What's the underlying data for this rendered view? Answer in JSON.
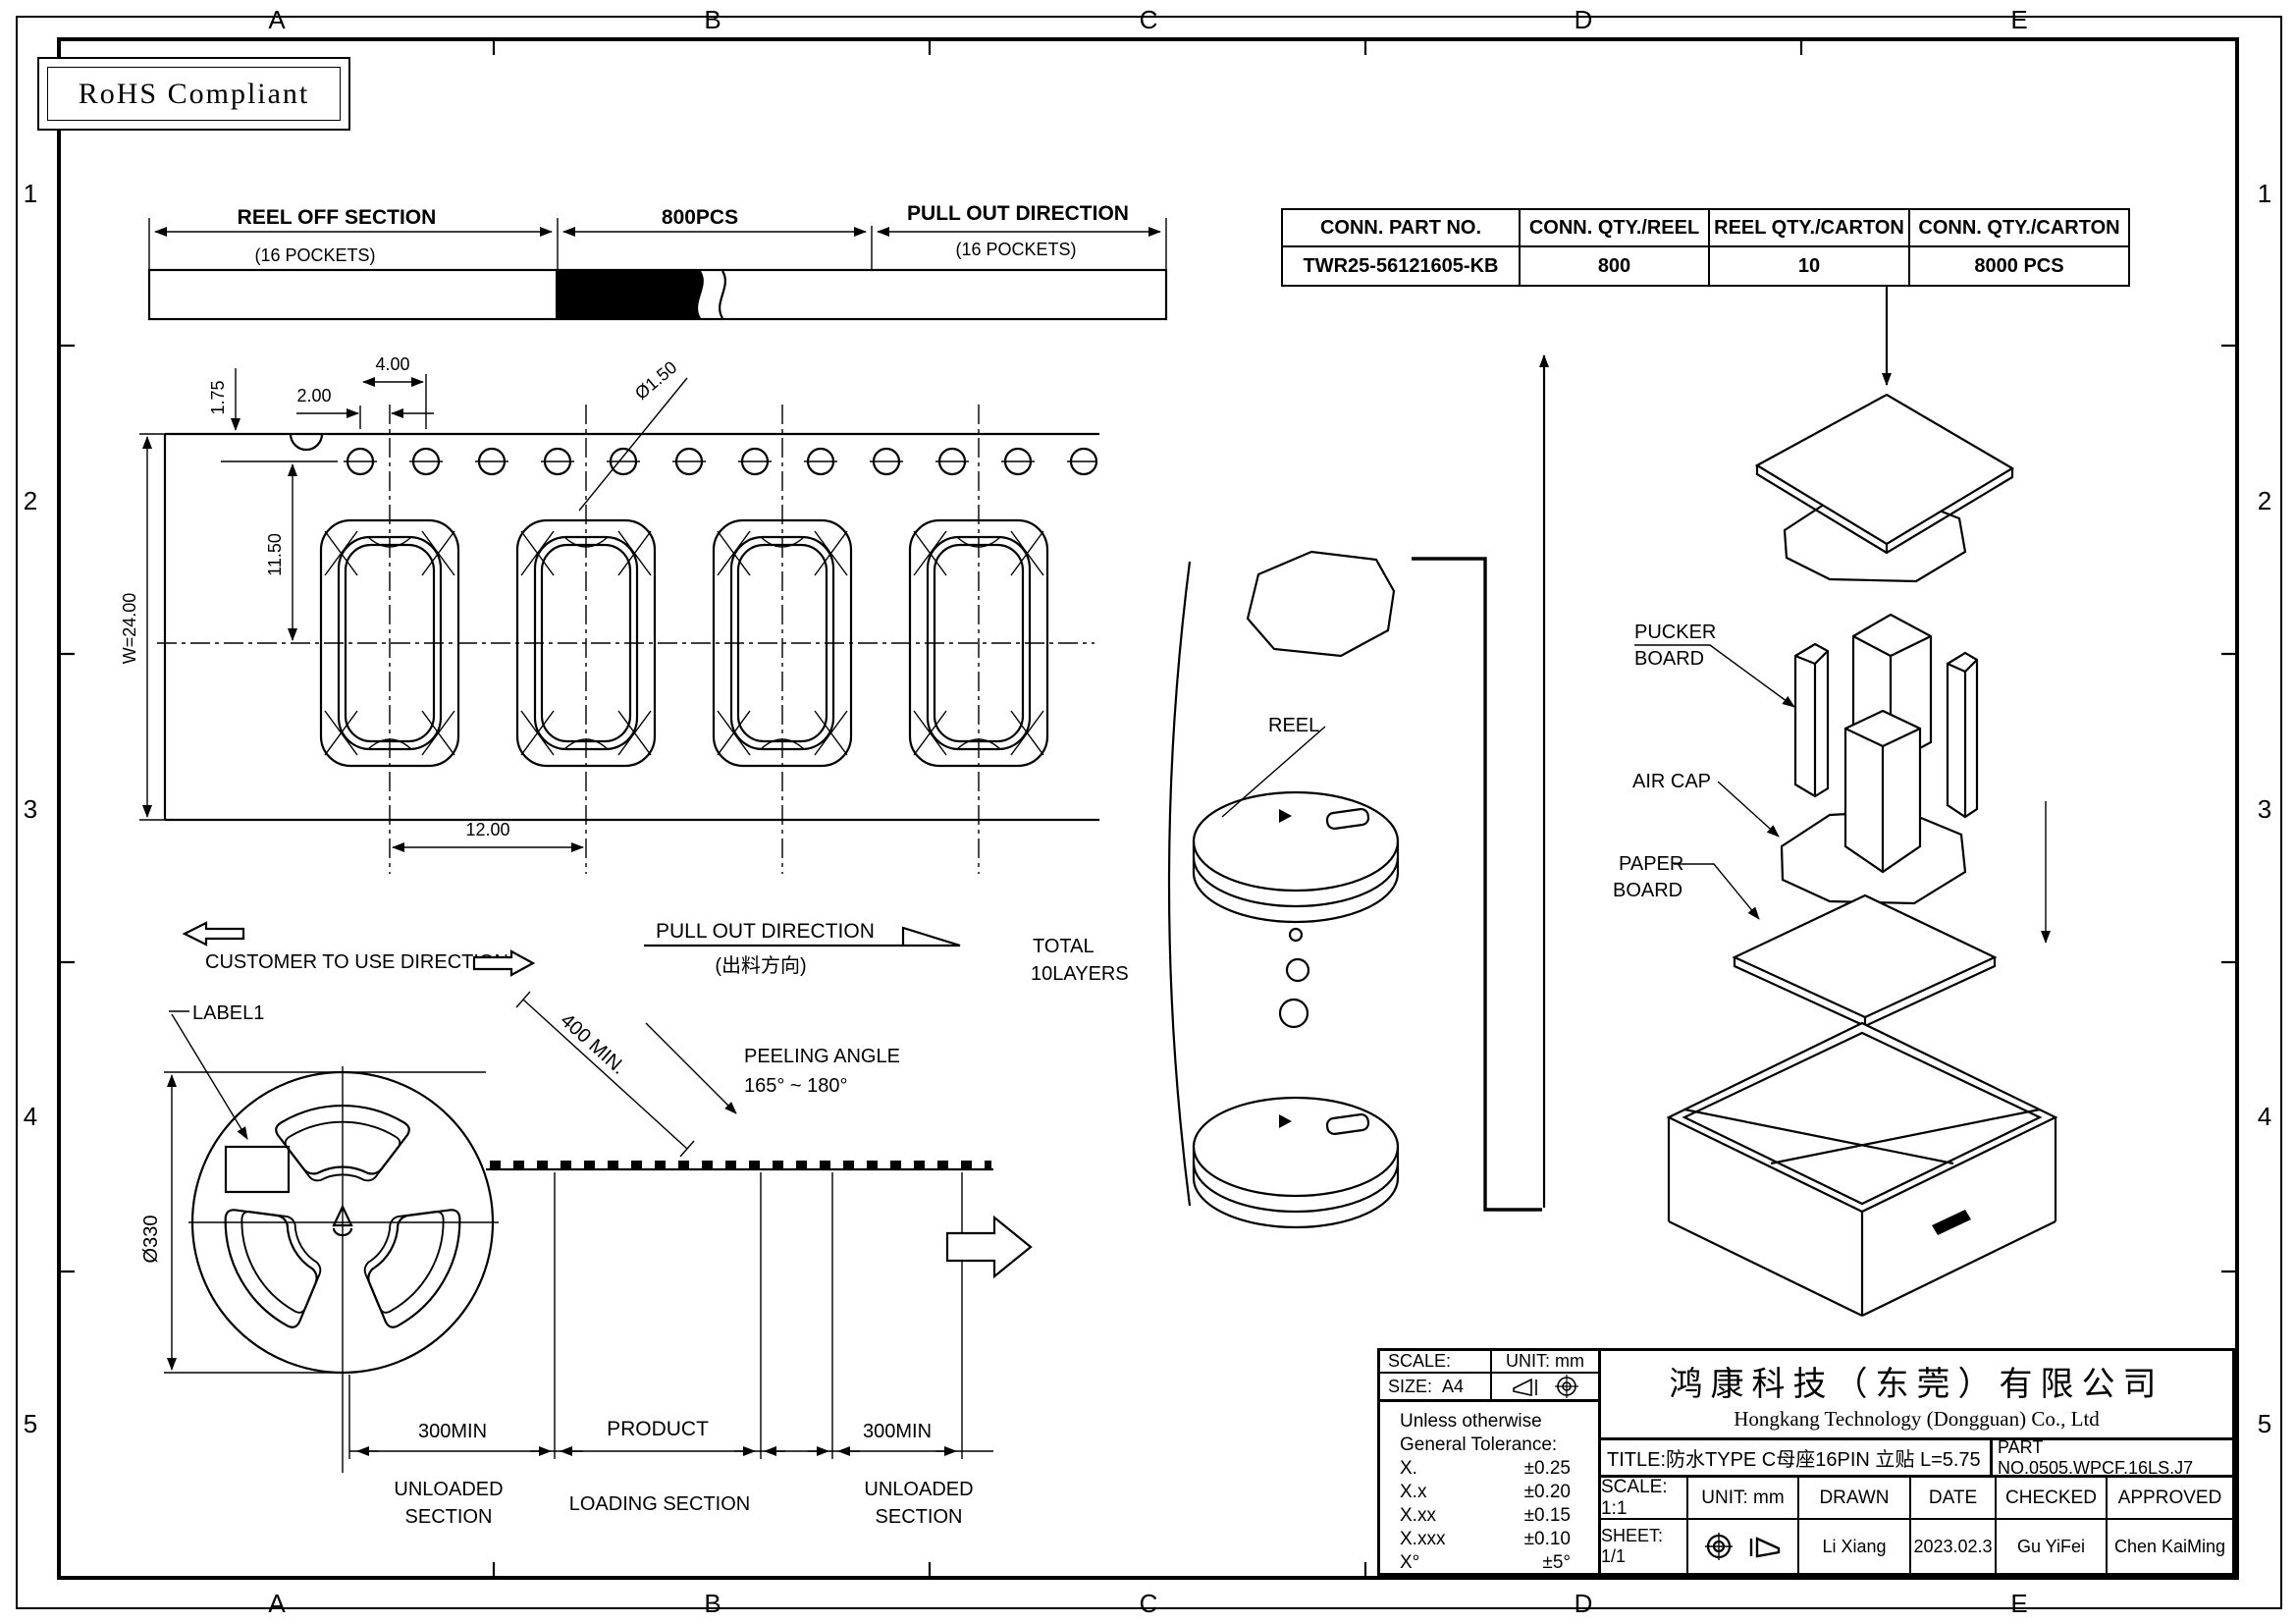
{
  "grid": {
    "cols": [
      "A",
      "B",
      "C",
      "D",
      "E"
    ],
    "rows": [
      "1",
      "2",
      "3",
      "4",
      "5"
    ]
  },
  "rohs": {
    "label": "RoHS Compliant"
  },
  "tape_overview": {
    "reel_off": "REEL OFF SECTION",
    "reel_off_sub": "(16 POCKETS)",
    "qty": "800PCS",
    "pull_out": "PULL OUT DIRECTION",
    "pull_out_sub": "(16 POCKETS)"
  },
  "summary_table": {
    "headers": [
      "CONN. PART NO.",
      "CONN. QTY./REEL",
      "REEL QTY./CARTON",
      "CONN. QTY./CARTON"
    ],
    "row": [
      "TWR25-56121605-KB",
      "800",
      "10",
      "8000 PCS"
    ]
  },
  "tape_detail": {
    "dim_edge": "1.75",
    "dim_offset": "2.00",
    "dim_pitch_small": "4.00",
    "dim_hole": "Ø1.50",
    "dim_center": "11.50",
    "dim_width": "W=24.00",
    "dim_pitch": "12.00"
  },
  "directions": {
    "customer": "CUSTOMER TO USE DIRECTION",
    "pull_out": "PULL OUT DIRECTION",
    "pull_out_cn": "(出料方向)",
    "total_1": "TOTAL",
    "total_2": "10LAYERS"
  },
  "reel": {
    "label1": "LABEL1",
    "diameter": "Ø330",
    "min_len": "400 MIN.",
    "peel_1": "PEELING ANGLE",
    "peel_2": "165° ~ 180°",
    "left_300": "300MIN",
    "product": "PRODUCT",
    "right_300": "300MIN",
    "unloaded_1": "UNLOADED",
    "unloaded_2": "SECTION",
    "loading": "LOADING SECTION",
    "reel_label": "REEL"
  },
  "packaging": {
    "pucker_1": "PUCKER",
    "pucker_2": "BOARD",
    "air_cap": "AIR CAP",
    "paper_1": "PAPER",
    "paper_2": "BOARD"
  },
  "title_block": {
    "scale_label": "SCALE:",
    "unit_label": "UNIT: mm",
    "size_label": "SIZE:",
    "size_value": "A4",
    "tol_head_1": "Unless otherwise",
    "tol_head_2": "General Tolerance:",
    "tolerances": [
      [
        "X.",
        "±0.25"
      ],
      [
        "X.x",
        "±0.20"
      ],
      [
        "X.xx",
        "±0.15"
      ],
      [
        "X.xxx",
        "±0.10"
      ],
      [
        "X°",
        "±5°"
      ]
    ],
    "company_cn": "鸿康科技（东莞）有限公司",
    "company_en": "Hongkang Technology (Dongguan) Co., Ltd",
    "title": "TITLE:防水TYPE C母座16PIN 立贴 L=5.75",
    "part_no": "PART NO.0505.WPCF.16LS.J7",
    "scale": "SCALE: 1:1",
    "unit": "UNIT: mm",
    "drawn_label": "DRAWN",
    "date_label": "DATE",
    "checked_label": "CHECKED",
    "approved_label": "APPROVED",
    "sheet": "SHEET: 1/1",
    "drawn": "Li Xiang",
    "date": "2023.02.3",
    "checked": "Gu YiFei",
    "approved": "Chen KaiMing"
  }
}
